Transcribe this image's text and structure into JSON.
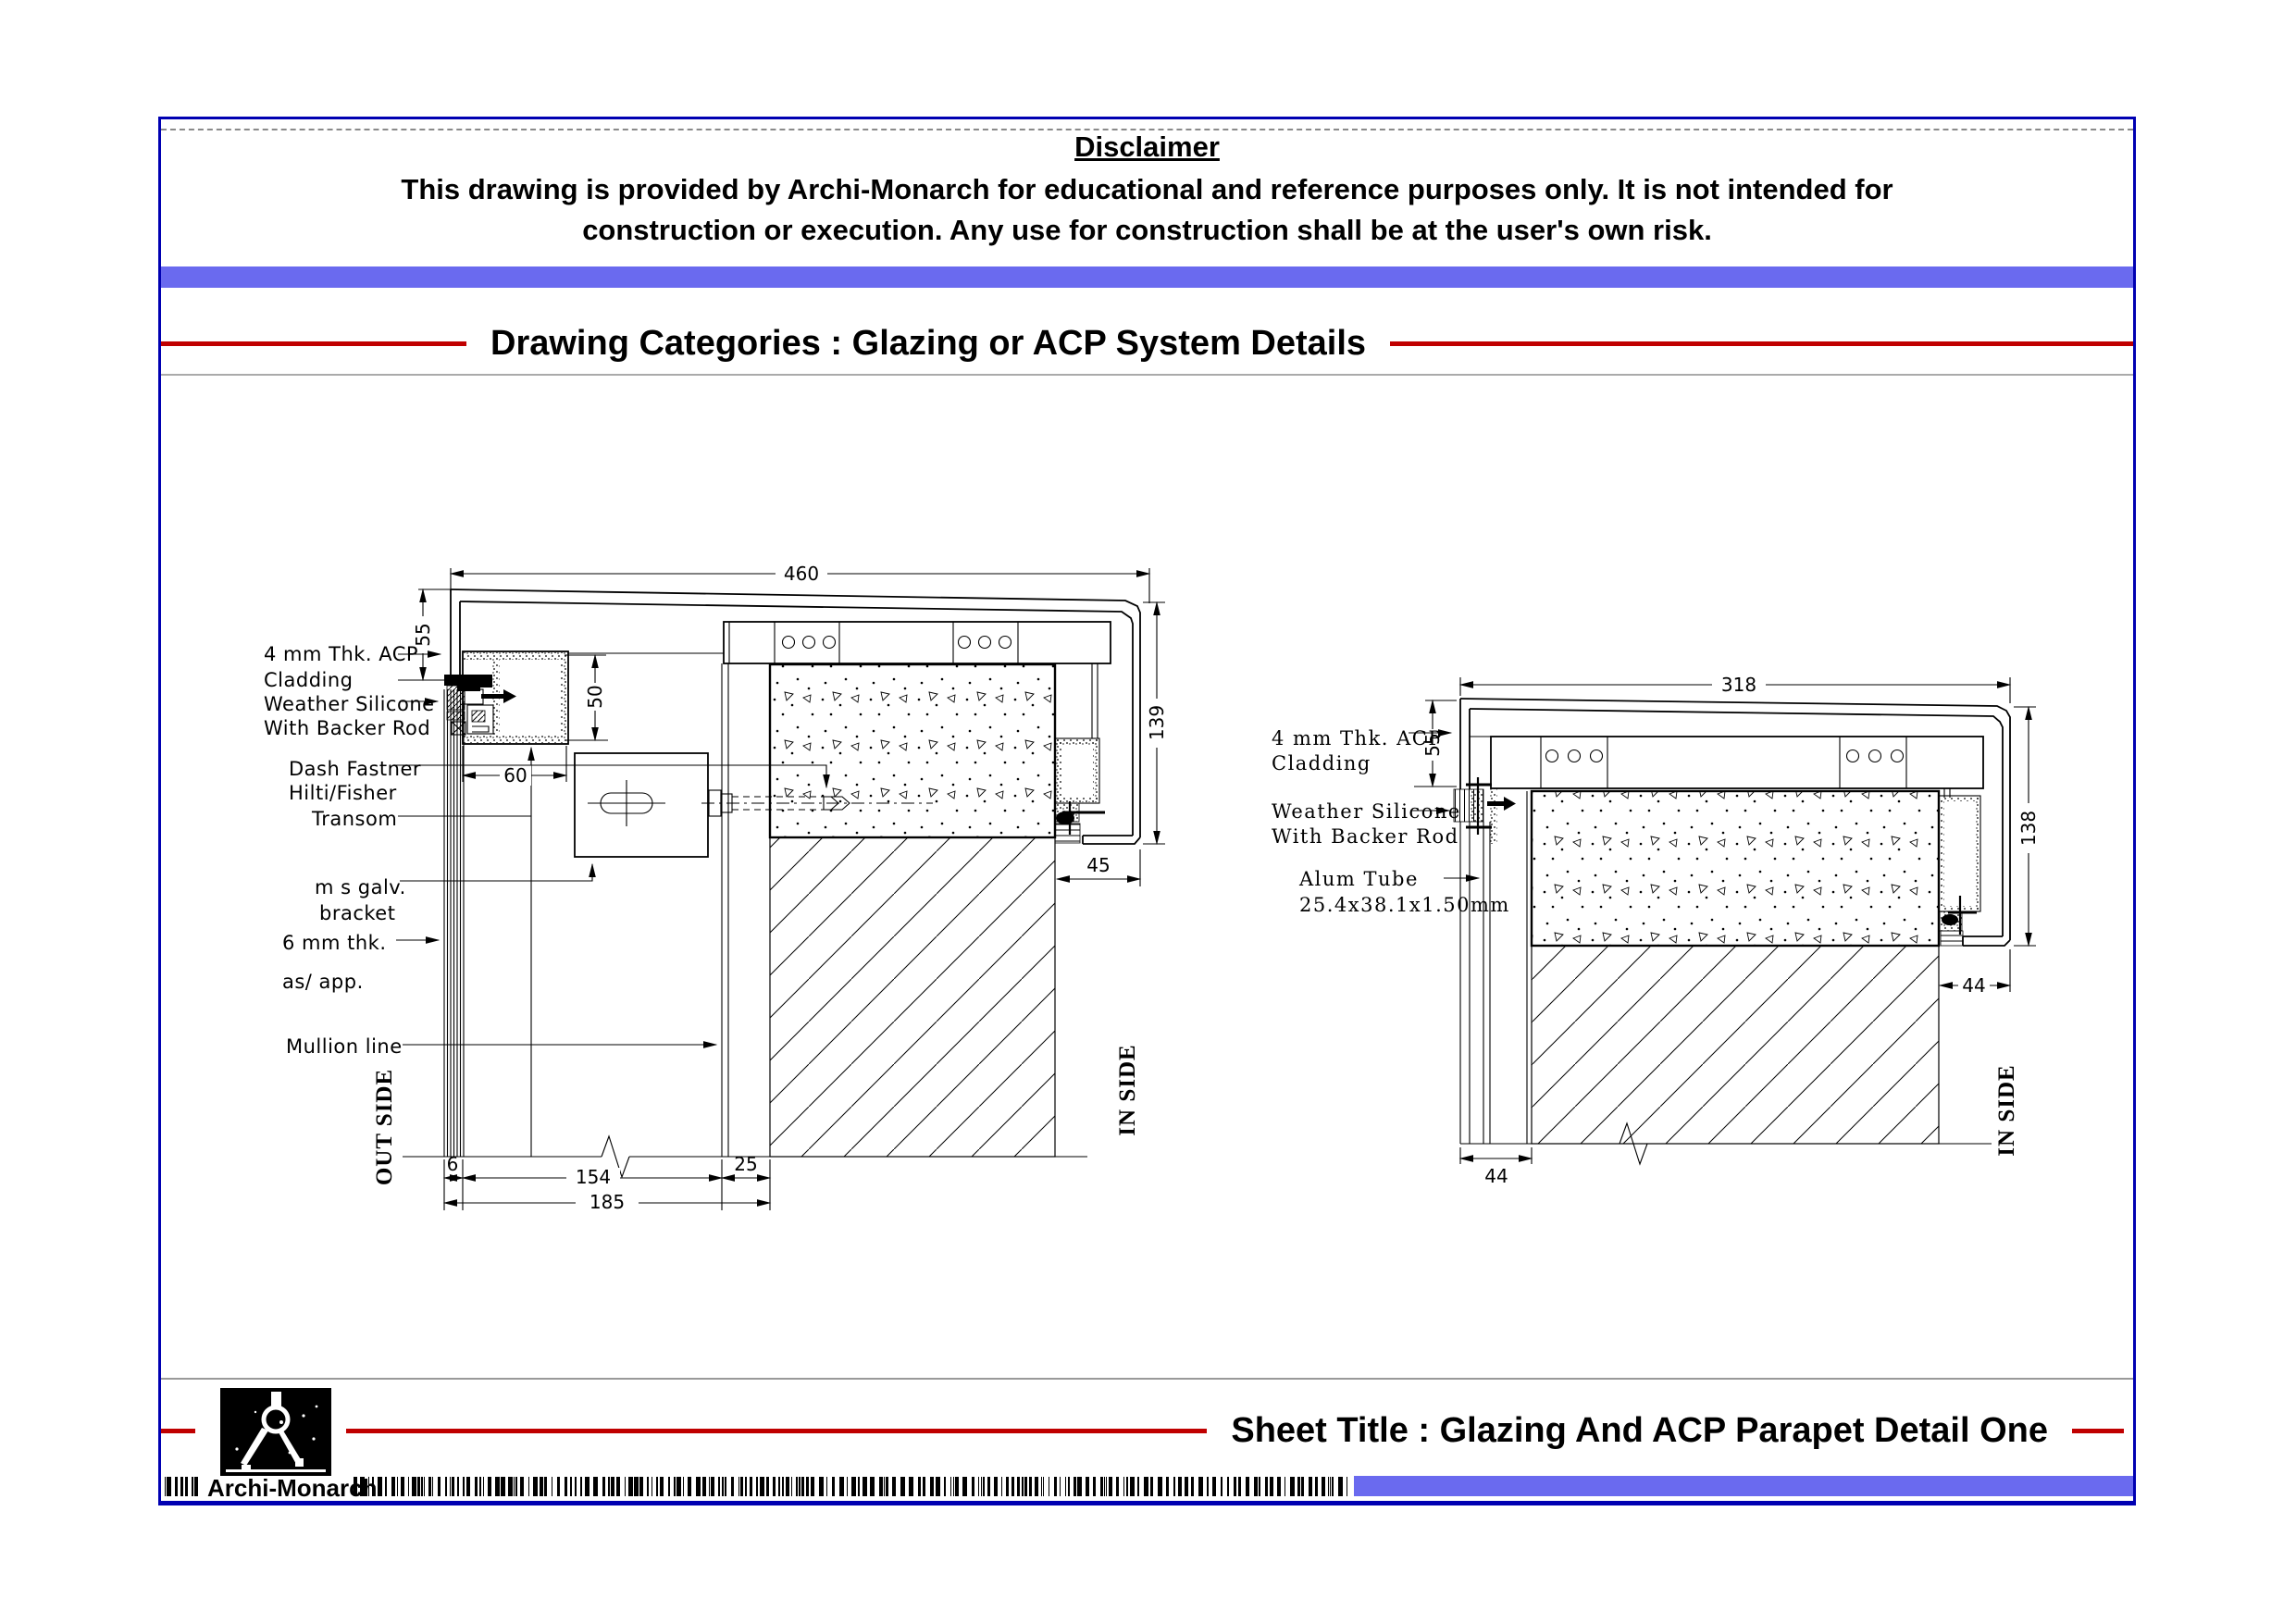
{
  "header": {
    "disclaimer_title": "Disclaimer",
    "disclaimer_line1": "This drawing is provided by Archi-Monarch for educational and reference purposes only. It is not intended for",
    "disclaimer_line2": "construction or execution. Any use for construction shall be at the user's own risk.",
    "category_heading": "Drawing Categories : Glazing or ACP System Details"
  },
  "footer": {
    "sheet_title": "Sheet Title : Glazing And ACP Parapet Detail One",
    "brand": "Archi-Monarch"
  },
  "colors": {
    "frame_blue": "#0000B2",
    "bar_blue": "#6A6AEF",
    "line_red": "#C00000",
    "drawing_black": "#000000"
  },
  "left_detail": {
    "label_acp_1": "4 mm Thk. ACP",
    "label_acp_2": "Cladding",
    "label_silicone_1": "Weather Silicone",
    "label_silicone_2": "With Backer Rod",
    "label_fastener_1": "Dash Fastner",
    "label_fastener_2": "Hilti/Fisher",
    "label_transom": "Transom",
    "label_bracket_1": "m s galv.",
    "label_bracket_2": "bracket",
    "label_thk_1": "6 mm thk.",
    "label_thk_2": "as/ app.",
    "label_mullion": "Mullion line",
    "out_side": "OUT SIDE",
    "in_side": "IN SIDE",
    "dim_top": "460",
    "dim_55": "55",
    "dim_50": "50",
    "dim_60": "60",
    "dim_139": "139",
    "dim_45": "45",
    "dim_6": "6",
    "dim_154": "154",
    "dim_25": "25",
    "dim_185": "185"
  },
  "right_detail": {
    "label_acp_1": "4 mm Thk. ACP",
    "label_acp_2": "Cladding",
    "label_silicone_1": "Weather Silicone",
    "label_silicone_2": "With Backer Rod",
    "label_tube_1": "Alum Tube",
    "label_tube_2": "25.4x38.1x1.50mm",
    "in_side": "IN SIDE",
    "dim_top": "318",
    "dim_55": "55",
    "dim_138": "138",
    "dim_44_right": "44",
    "dim_44_bottom": "44"
  }
}
